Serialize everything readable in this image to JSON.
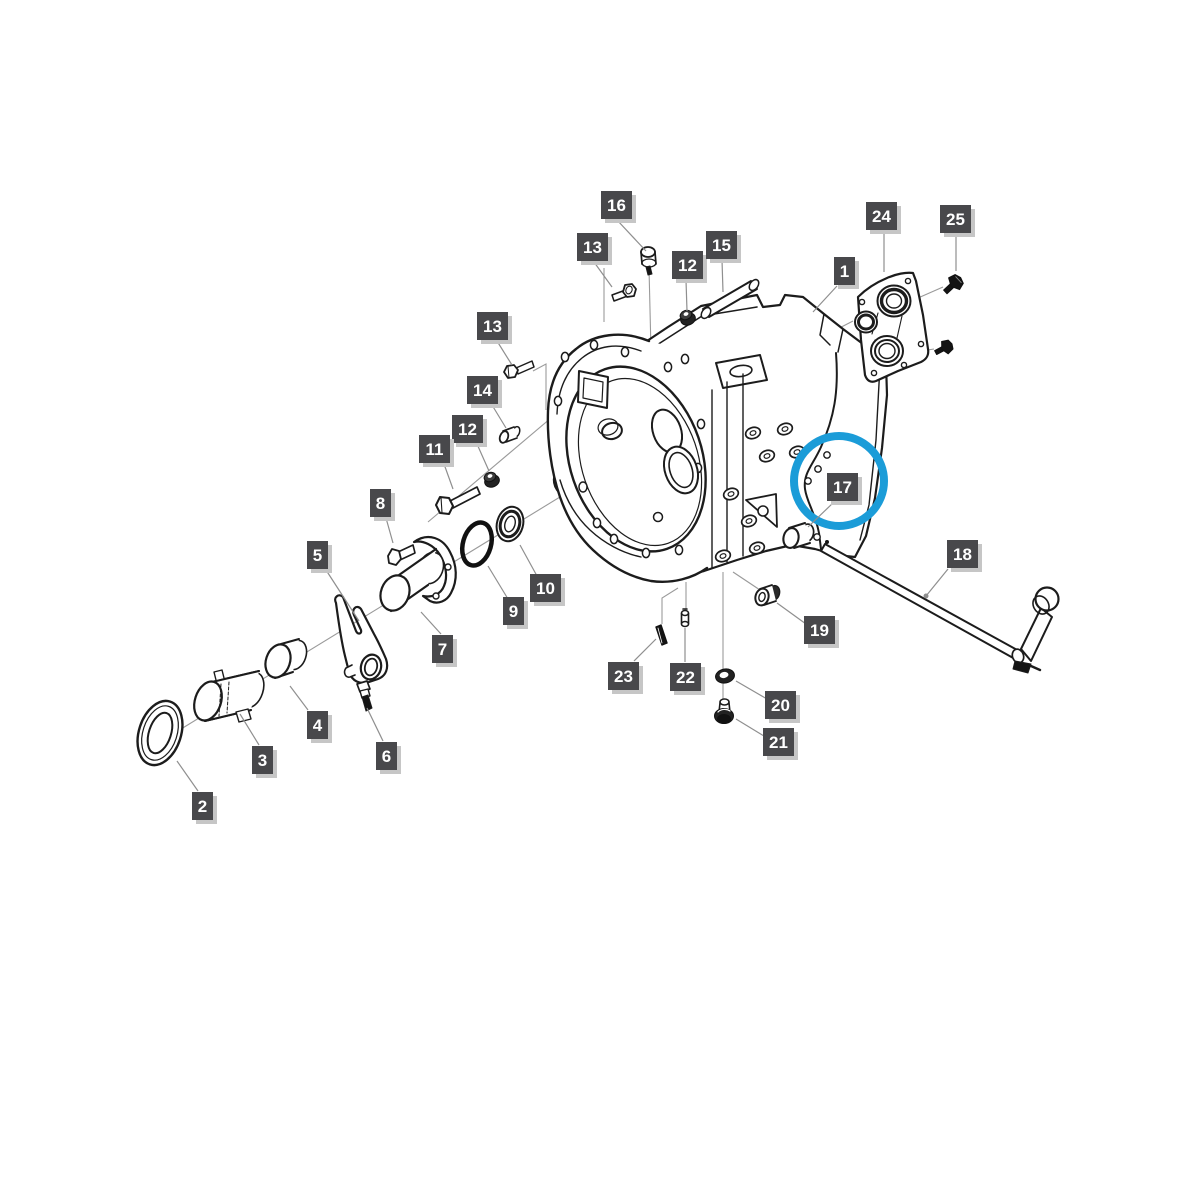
{
  "figure": {
    "type": "exploded-parts-diagram",
    "subject": "clutch-housing-assembly-diagram",
    "canvas": {
      "width": 1200,
      "height": 1200,
      "background": "#ffffff"
    },
    "colors": {
      "line": "#1c1c1c",
      "leader": "#8f8f8f",
      "label_bg": "#48484b",
      "label_text": "#ffffff",
      "label_shadow": "#c6c6c6",
      "highlight": "#1b9cd8"
    },
    "highlight": {
      "part": "17",
      "shape": "circle",
      "cx": 839,
      "cy": 481,
      "r": 45,
      "stroke_width": 8
    },
    "callouts": [
      {
        "label": "16",
        "x": 601,
        "y": 191,
        "leader": [
          [
            617,
            220,
            646,
            251
          ]
        ]
      },
      {
        "label": "13",
        "x": 577,
        "y": 233,
        "leader": [
          [
            594,
            262,
            612,
            287
          ]
        ]
      },
      {
        "label": "12",
        "x": 672,
        "y": 251,
        "leader": [
          [
            686,
            280,
            687,
            311
          ]
        ]
      },
      {
        "label": "15",
        "x": 706,
        "y": 231,
        "leader": [
          [
            722,
            260,
            723,
            292
          ]
        ]
      },
      {
        "label": "1",
        "x": 834,
        "y": 257,
        "leader": [
          [
            837,
            286,
            813,
            312
          ]
        ]
      },
      {
        "label": "24",
        "x": 866,
        "y": 202,
        "leader": [
          [
            884,
            231,
            884,
            272
          ]
        ]
      },
      {
        "label": "25",
        "x": 940,
        "y": 205,
        "leader": [
          [
            956,
            234,
            956,
            271
          ]
        ]
      },
      {
        "label": "13",
        "x": 477,
        "y": 312,
        "leader": [
          [
            497,
            341,
            512,
            365
          ]
        ]
      },
      {
        "label": "14",
        "x": 467,
        "y": 376,
        "leader": [
          [
            492,
            405,
            506,
            428
          ]
        ]
      },
      {
        "label": "12",
        "x": 452,
        "y": 415,
        "leader": [
          [
            477,
            444,
            489,
            471
          ]
        ]
      },
      {
        "label": "11",
        "x": 419,
        "y": 435,
        "leader": [
          [
            444,
            464,
            453,
            489
          ]
        ]
      },
      {
        "label": "8",
        "x": 370,
        "y": 489,
        "leader": [
          [
            386,
            518,
            393,
            543
          ]
        ]
      },
      {
        "label": "5",
        "x": 307,
        "y": 541,
        "leader": [
          [
            326,
            570,
            359,
            621
          ]
        ]
      },
      {
        "label": "10",
        "x": 530,
        "y": 574,
        "leader": [
          [
            520,
            545,
            537,
            576
          ]
        ]
      },
      {
        "label": "9",
        "x": 503,
        "y": 597,
        "leader": [
          [
            488,
            566,
            508,
            599
          ]
        ]
      },
      {
        "label": "7",
        "x": 432,
        "y": 635,
        "leader": [
          [
            441,
            634,
            421,
            612
          ]
        ]
      },
      {
        "label": "4",
        "x": 307,
        "y": 711,
        "leader": [
          [
            308,
            710,
            290,
            686
          ]
        ]
      },
      {
        "label": "6",
        "x": 376,
        "y": 742,
        "leader": [
          [
            383,
            741,
            367,
            708
          ]
        ]
      },
      {
        "label": "3",
        "x": 252,
        "y": 746,
        "leader": [
          [
            259,
            745,
            240,
            714
          ]
        ]
      },
      {
        "label": "2",
        "x": 192,
        "y": 792,
        "leader": [
          [
            198,
            791,
            177,
            761
          ]
        ]
      },
      {
        "label": "17",
        "x": 827,
        "y": 473,
        "leader": [
          [
            834,
            502,
            808,
            527
          ]
        ]
      },
      {
        "label": "18",
        "x": 947,
        "y": 540,
        "leader": [
          [
            948,
            569,
            926,
            596
          ]
        ],
        "dot": [
          926,
          596
        ]
      },
      {
        "label": "19",
        "x": 804,
        "y": 616,
        "leader": [
          [
            806,
            624,
            777,
            603
          ]
        ]
      },
      {
        "label": "20",
        "x": 765,
        "y": 691,
        "leader": [
          [
            767,
            699,
            736,
            681
          ]
        ]
      },
      {
        "label": "21",
        "x": 763,
        "y": 728,
        "leader": [
          [
            764,
            736,
            736,
            719
          ]
        ]
      },
      {
        "label": "22",
        "x": 670,
        "y": 663,
        "leader": [
          [
            685,
            662,
            685,
            628
          ]
        ]
      },
      {
        "label": "23",
        "x": 608,
        "y": 662,
        "leader": [
          [
            634,
            661,
            656,
            639
          ]
        ]
      }
    ]
  }
}
